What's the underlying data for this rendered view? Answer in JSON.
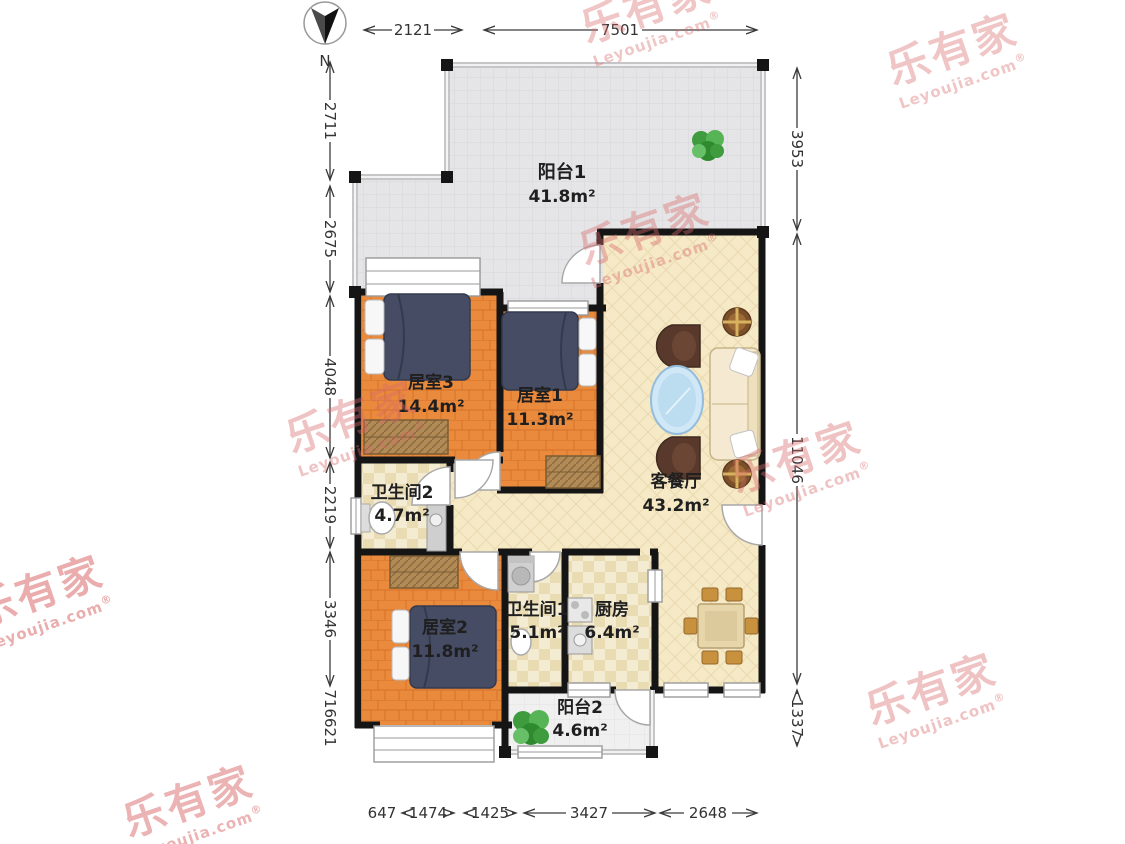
{
  "compass": {
    "label": "N"
  },
  "brand": {
    "name": "乐有家",
    "domain": "Leyoujia.com",
    "registered": "®"
  },
  "dimensions": {
    "top": [
      {
        "value": "2121"
      },
      {
        "value": "7501"
      }
    ],
    "left": [
      {
        "value": "2711"
      },
      {
        "value": "2675"
      },
      {
        "value": "4048"
      },
      {
        "value": "2219"
      },
      {
        "value": "3346"
      },
      {
        "value": "716"
      },
      {
        "value": "621"
      }
    ],
    "right": [
      {
        "value": "3953"
      },
      {
        "value": "11046"
      },
      {
        "value": "1337"
      }
    ],
    "bottom": [
      {
        "value": "647"
      },
      {
        "value": "1474"
      },
      {
        "value": "1425"
      },
      {
        "value": "3427"
      },
      {
        "value": "2648"
      }
    ]
  },
  "rooms": [
    {
      "id": "balcony1",
      "name": "阳台1",
      "area": "41.8m²"
    },
    {
      "id": "bedroom3",
      "name": "居室3",
      "area": "14.4m²"
    },
    {
      "id": "bedroom1",
      "name": "居室1",
      "area": "11.3m²"
    },
    {
      "id": "living_dining",
      "name": "客餐厅",
      "area": "43.2m²"
    },
    {
      "id": "bathroom2",
      "name": "卫生间2",
      "area": "4.7m²"
    },
    {
      "id": "bedroom2",
      "name": "居室2",
      "area": "11.8m²"
    },
    {
      "id": "bathroom1",
      "name": "卫生间1",
      "area": "5.1m²"
    },
    {
      "id": "kitchen",
      "name": "厨房",
      "area": "6.4m²"
    },
    {
      "id": "balcony2",
      "name": "阳台2",
      "area": "4.6m²"
    }
  ]
}
